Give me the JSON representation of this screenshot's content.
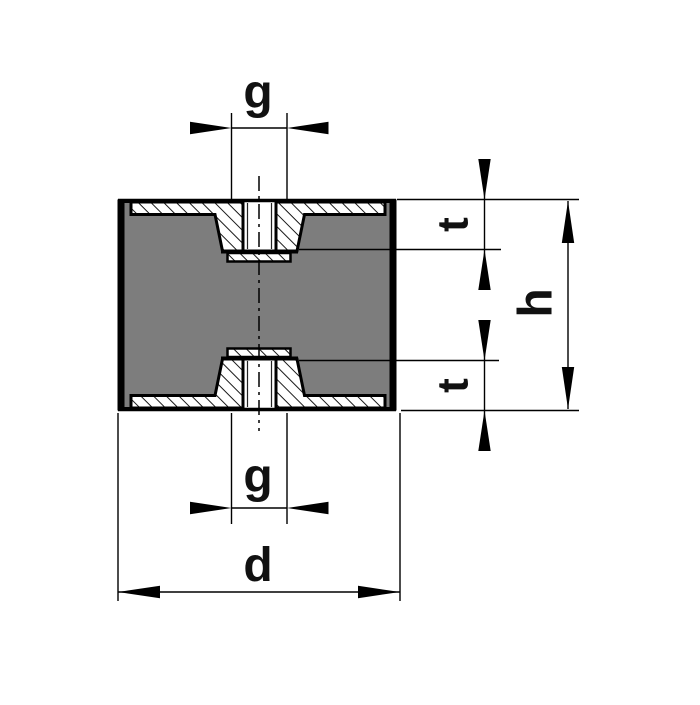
{
  "drawing": {
    "kind": "rubber-metal-buffer-cross-section",
    "labels": {
      "thread_top": "g",
      "thread_bottom": "g",
      "depth_top": "t",
      "depth_bottom": "t",
      "height": "h",
      "diameter": "d"
    },
    "colors": {
      "line": "#000000",
      "rubber": "#7d7d7d",
      "metal": "#ffffff",
      "background": "#ffffff"
    }
  }
}
